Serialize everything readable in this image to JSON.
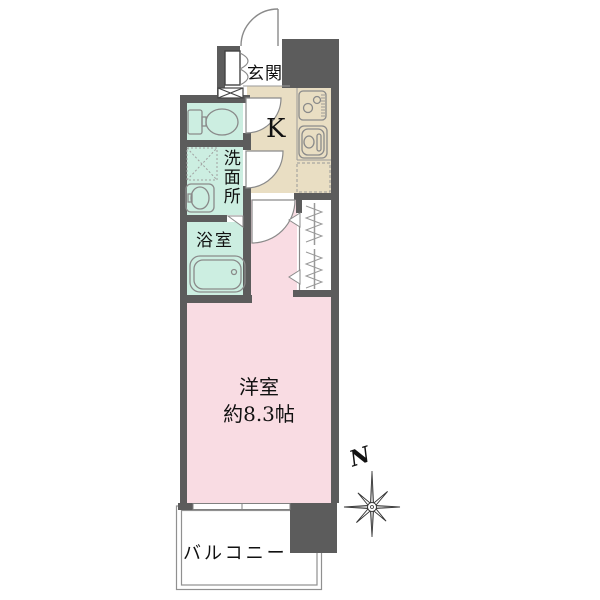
{
  "rooms": {
    "genkan": {
      "label": "玄関"
    },
    "kitchen": {
      "label": "K"
    },
    "washroom": {
      "label": "洗面所"
    },
    "bathroom": {
      "label": "浴室"
    },
    "western_room": {
      "label": "洋室",
      "size": "約8.3帖"
    },
    "balcony": {
      "label": "バルコニー"
    }
  },
  "compass": {
    "north_label": "N"
  },
  "colors": {
    "wall": "#5c5c5c",
    "kitchen_floor": "#e9dec3",
    "wet_area_floor": "#cceee1",
    "western_room_floor": "#f9dce3",
    "closet_floor": "#ffffff",
    "balcony_floor": "#ffffff"
  }
}
